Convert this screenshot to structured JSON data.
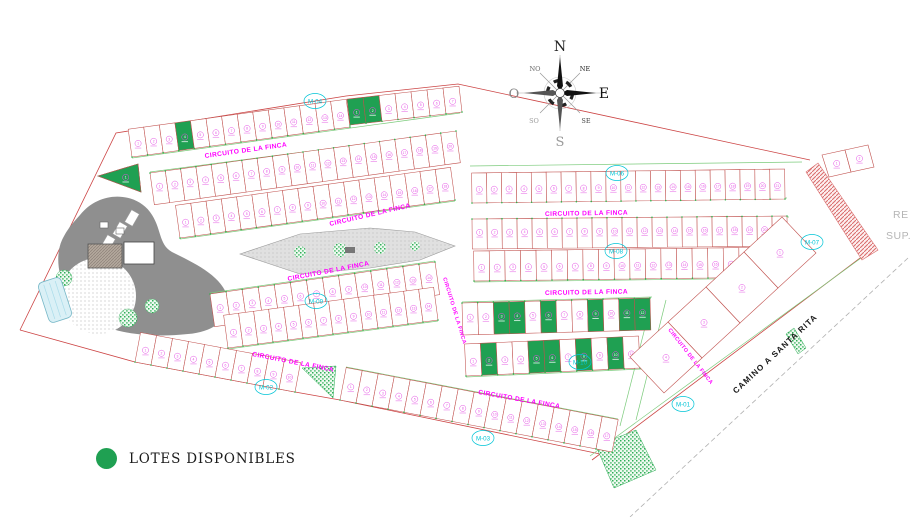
{
  "legend": {
    "label": "LOTES DISPONIBLES"
  },
  "streets": {
    "circuito": "CIRCUITO DE LA FINCA",
    "camino": "CAMINO A SANTA RITA"
  },
  "compass": {
    "n": "N",
    "ne": "NE",
    "e": "E",
    "se": "SE",
    "s": "S",
    "so": "SO",
    "o": "O",
    "no": "NO"
  },
  "block_labels": [
    "M-04",
    "M-06",
    "M-07",
    "M-08",
    "M-09",
    "M-10",
    "M-02",
    "M-03",
    "M-01"
  ],
  "edge_text": {
    "line1": "RE",
    "line2": "SUP."
  },
  "colors": {
    "available_green": "#1fa052",
    "lot_line": "#c0504d",
    "street_green": "#7ccb7c",
    "street_text": "#ff00ff",
    "block_text": "#00c4d6",
    "lot_text": "#e44fe4",
    "boundary_red": "#cc4444",
    "hatch_red": "#d96b6b",
    "amenity_gray": "#8f8f8f",
    "edge_text_gray": "#b5b5b5"
  },
  "blocks": [
    {
      "lots": 14,
      "available": [
        3
      ]
    },
    {
      "lots": 7,
      "available": [
        0,
        1
      ]
    },
    {
      "lots": 20,
      "available": []
    },
    {
      "lots": 18,
      "available": []
    },
    {
      "lots": 14,
      "available": []
    },
    {
      "lots": 14,
      "available": []
    },
    {
      "lots": 10,
      "available": []
    },
    {
      "lots": 17,
      "available": []
    },
    {
      "lots": 21,
      "available": []
    },
    {
      "lots": 21,
      "available": []
    },
    {
      "lots": 20,
      "available": [
        19
      ]
    },
    {
      "lots": 12,
      "available": [
        2,
        3,
        5,
        8,
        10,
        11
      ]
    },
    {
      "lots": 11,
      "available": [
        1,
        4,
        5,
        7,
        9
      ]
    },
    {
      "lots": 4,
      "available": []
    },
    {
      "lots": 2,
      "available": []
    },
    {
      "lots": 1,
      "available": [
        0
      ]
    }
  ]
}
